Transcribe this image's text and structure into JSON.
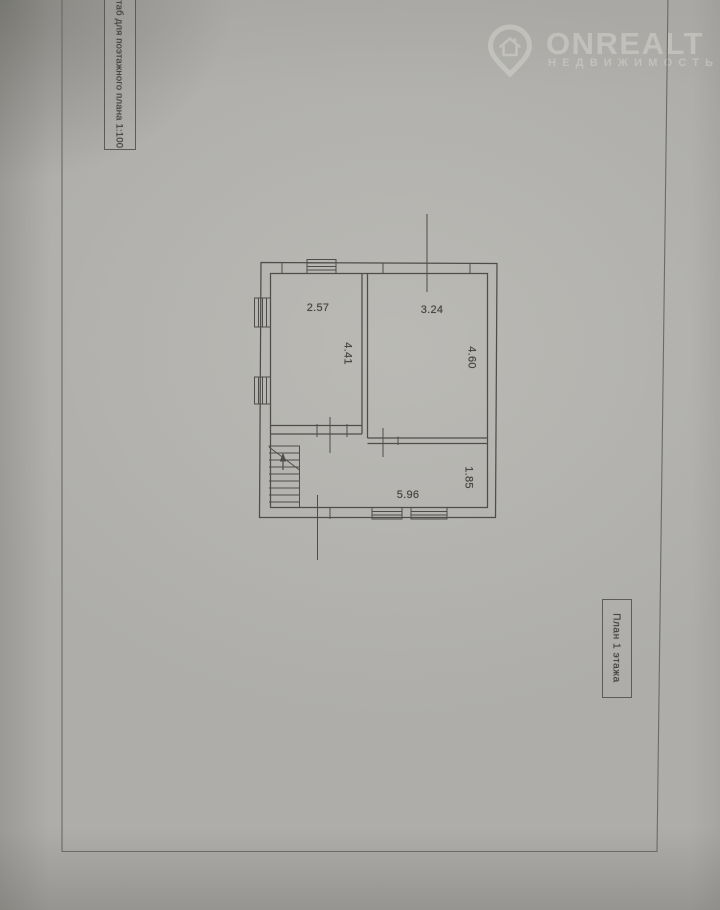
{
  "watermark": {
    "brand": "ONREALT",
    "tagline": "НЕДВИЖИМОСТЬ",
    "icon": "location-pin-house-icon",
    "color": "#d6d6d0"
  },
  "side_labels": {
    "scale_note": "Масштаб для поэтажного плана 1:100",
    "plan_title": "План 1 этажа"
  },
  "floorplan": {
    "dimensions": {
      "room_left_width": "2.57",
      "room_left_depth": "4.41",
      "room_right_width": "3.24",
      "room_right_depth": "4.60",
      "hall_width": "5.96",
      "hall_depth": "1.85"
    },
    "features": [
      "stairs",
      "up-arrow",
      "windows",
      "door-openings"
    ]
  },
  "colors": {
    "paper": "#aeadaa",
    "ink": "#4e4d4a",
    "frame": "#6a6a66"
  }
}
